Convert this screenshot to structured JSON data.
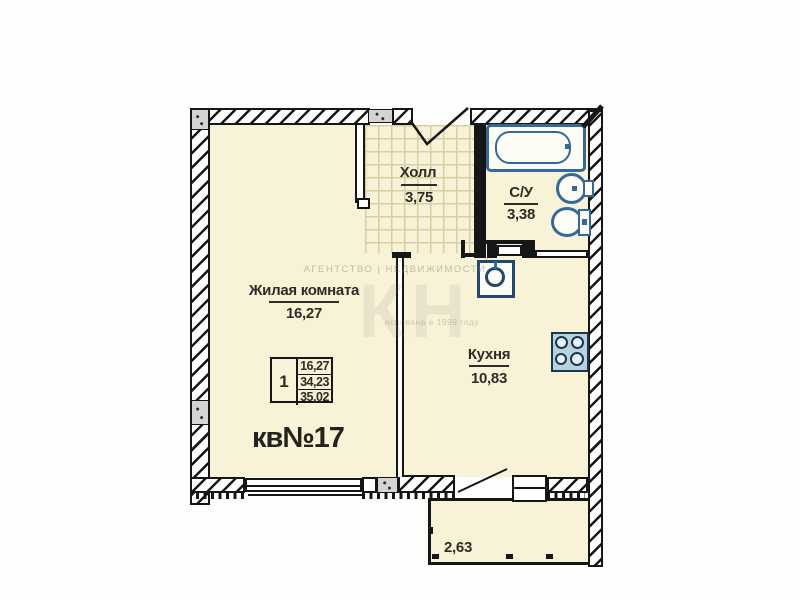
{
  "apartment": {
    "number": "кв№17"
  },
  "rooms": {
    "living": {
      "name": "Жилая комната",
      "area": "16,27"
    },
    "hall": {
      "name": "Холл",
      "area": "3,75"
    },
    "wc": {
      "name": "С/У",
      "area": "3,38"
    },
    "kitchen": {
      "name": "Кухня",
      "area": "10,83"
    },
    "balcony": {
      "area": "2,63"
    }
  },
  "info_table": {
    "rooms_count": "1",
    "living_area": "16,27",
    "apartment_area": "34,23",
    "total_area": "35,02"
  },
  "watermark": {
    "agency_line": "АГЕНТСТВО | НЕДВИЖИМОСТИ",
    "logo": "КН",
    "founded_line": "основана в 1999 году"
  },
  "colors": {
    "floor": "#f8f3d6",
    "wall": "#161616",
    "fixture_blue": "#33699c",
    "tile_grid": "#d8cfa4"
  }
}
